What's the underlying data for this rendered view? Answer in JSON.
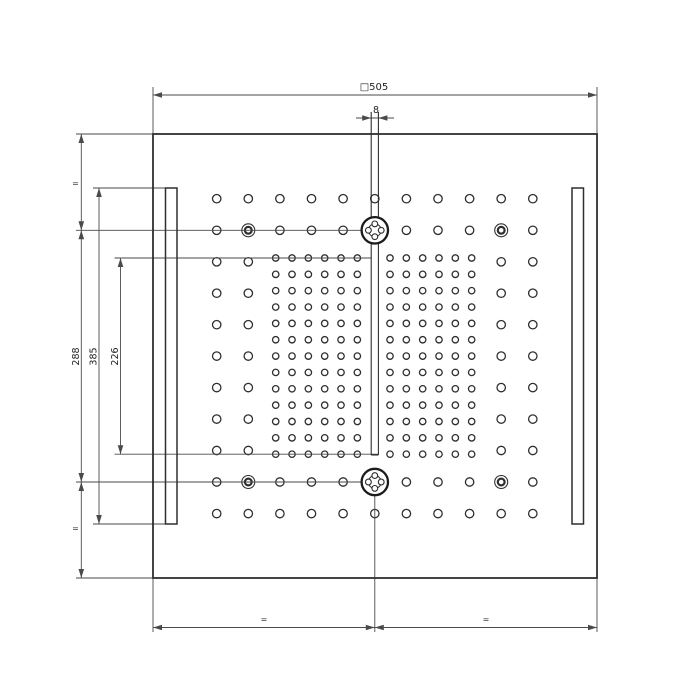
{
  "title": "Square ceiling shower head – dimensioned technical drawing",
  "canvas": {
    "w": 700,
    "h": 700,
    "bg": "#ffffff"
  },
  "style": {
    "dim_color": "#4a4a4a",
    "struct_color": "#2f2f2f",
    "hole_color": "#2e2e2e",
    "text_color": "#1f1f1f",
    "dim_w": 0.9,
    "panel_w": 1.8,
    "slot_w": 1.5,
    "channel_w": 1.1,
    "hole_w": 1.3,
    "arrow_len": 9,
    "arrow_halfw": 2.8
  },
  "dimensions": {
    "overall_square": "505",
    "channel_width": "8",
    "vertical_left": [
      "288",
      "385",
      "226"
    ],
    "equal_spacing_marks": [
      "=",
      "=",
      "=",
      "="
    ]
  },
  "panel": {
    "x": 153,
    "y": 134,
    "w": 444,
    "h": 444
  },
  "slots": [
    {
      "x": 165.5,
      "y": 188,
      "w": 11.5,
      "h": 336
    },
    {
      "x": 572.0,
      "y": 188,
      "w": 11.5,
      "h": 336
    }
  ],
  "channel": {
    "x1": 371.2,
    "x2": 378.4,
    "top": 112,
    "bottom": 455
  },
  "sparse_grid": {
    "hole_r": 4.2,
    "cols": [
      216.7,
      248.3,
      279.9,
      311.5,
      343.1,
      374.8,
      406.4,
      438.0,
      469.6,
      501.2,
      532.8
    ],
    "full_rows": [
      198.7,
      230.3,
      482.0,
      513.6
    ],
    "side_rows": [
      261.8,
      293.2,
      324.7,
      356.1,
      387.6,
      419.1,
      450.5
    ],
    "side_cols": [
      216.7,
      248.3,
      501.2,
      532.8
    ]
  },
  "dense_grid": {
    "hole_r": 3.2,
    "x0": 275.7,
    "y0": 258,
    "step_x": 16.33,
    "step_y": 16.35,
    "nx": 13,
    "ny": 13,
    "skip_col": 6
  },
  "features": {
    "nozzle_r": 13.2,
    "nozzle_ring_r": 6.4,
    "nozzle_petal_r": 2.9,
    "nozzles": [
      {
        "cx": 374.8,
        "cy": 230.3
      },
      {
        "cx": 374.8,
        "cy": 482.0
      }
    ],
    "ringed_outer_r": 6.5,
    "ringed_inner_r": 3.4,
    "ringed": [
      {
        "cx": 248.3,
        "cy": 230.3
      },
      {
        "cx": 501.2,
        "cy": 230.3
      },
      {
        "cx": 248.3,
        "cy": 482.0
      },
      {
        "cx": 501.2,
        "cy": 482.0
      }
    ]
  },
  "lines": [
    {
      "x1": 153,
      "y1": 95,
      "x2": 597,
      "y2": 95,
      "name": "dim-line-overall-505"
    },
    {
      "x1": 153,
      "y1": 87,
      "x2": 153,
      "y2": 134,
      "name": "ext-line-top-left"
    },
    {
      "x1": 597,
      "y1": 87,
      "x2": 597,
      "y2": 134,
      "name": "ext-line-top-right"
    },
    {
      "x1": 356,
      "y1": 118,
      "x2": 394,
      "y2": 118,
      "name": "dim-line-channel-8"
    },
    {
      "x1": 81.3,
      "y1": 134,
      "x2": 81.3,
      "y2": 578,
      "name": "dim-line-left-stack"
    },
    {
      "x1": 99,
      "y1": 188,
      "x2": 99,
      "y2": 524,
      "name": "dim-line-385"
    },
    {
      "x1": 120.5,
      "y1": 258,
      "x2": 120.5,
      "y2": 454.2,
      "name": "dim-line-226"
    },
    {
      "x1": 76,
      "y1": 134,
      "x2": 153,
      "y2": 134,
      "name": "ext-line-panel-top"
    },
    {
      "x1": 76,
      "y1": 230.3,
      "x2": 361.8,
      "y2": 230.3,
      "name": "ext-line-upper-jet-row"
    },
    {
      "x1": 93,
      "y1": 188,
      "x2": 165.5,
      "y2": 188,
      "name": "ext-line-slot-top"
    },
    {
      "x1": 114.5,
      "y1": 258,
      "x2": 371.2,
      "y2": 258,
      "name": "ext-line-dense-top"
    },
    {
      "x1": 114.5,
      "y1": 454.2,
      "x2": 378.4,
      "y2": 454.2,
      "name": "ext-line-dense-bottom"
    },
    {
      "x1": 76,
      "y1": 482,
      "x2": 361.8,
      "y2": 482,
      "name": "ext-line-lower-jet-row"
    },
    {
      "x1": 93,
      "y1": 524,
      "x2": 177,
      "y2": 524,
      "name": "ext-line-slot-bottom"
    },
    {
      "x1": 76,
      "y1": 578,
      "x2": 153,
      "y2": 578,
      "name": "ext-line-panel-bottom"
    },
    {
      "x1": 153,
      "y1": 627.5,
      "x2": 597,
      "y2": 627.5,
      "name": "dim-line-bottom-equal"
    },
    {
      "x1": 153,
      "y1": 578,
      "x2": 153,
      "y2": 632,
      "name": "ext-line-bottom-left"
    },
    {
      "x1": 597,
      "y1": 578,
      "x2": 597,
      "y2": 632,
      "name": "ext-line-bottom-right"
    },
    {
      "x1": 374.8,
      "y1": 495,
      "x2": 374.8,
      "y2": 632,
      "name": "ext-line-center"
    }
  ],
  "arrows": [
    {
      "x": 153,
      "y": 95,
      "dir": "left",
      "name": "arrow-505-left"
    },
    {
      "x": 597,
      "y": 95,
      "dir": "right",
      "name": "arrow-505-right"
    },
    {
      "x": 371.2,
      "y": 118,
      "dir": "right",
      "name": "arrow-8-left"
    },
    {
      "x": 378.4,
      "y": 118,
      "dir": "left",
      "name": "arrow-8-right"
    },
    {
      "x": 81.3,
      "y": 134,
      "dir": "up",
      "name": "arrow-eq-top"
    },
    {
      "x": 81.3,
      "y": 230.3,
      "dir": "down",
      "name": "arrow-288-top-meet"
    },
    {
      "x": 81.3,
      "y": 230.3,
      "dir": "up",
      "name": "arrow-288-top"
    },
    {
      "x": 81.3,
      "y": 482,
      "dir": "down",
      "name": "arrow-288-bottom"
    },
    {
      "x": 81.3,
      "y": 482,
      "dir": "up",
      "name": "arrow-eq-bottom-meet"
    },
    {
      "x": 81.3,
      "y": 578,
      "dir": "down",
      "name": "arrow-eq-bottom"
    },
    {
      "x": 99,
      "y": 188,
      "dir": "up",
      "name": "arrow-385-top"
    },
    {
      "x": 99,
      "y": 524,
      "dir": "down",
      "name": "arrow-385-bottom"
    },
    {
      "x": 120.5,
      "y": 258,
      "dir": "up",
      "name": "arrow-226-top"
    },
    {
      "x": 120.5,
      "y": 454.2,
      "dir": "down",
      "name": "arrow-226-bottom"
    },
    {
      "x": 153,
      "y": 627.5,
      "dir": "left",
      "name": "arrow-bottom-eq1-left"
    },
    {
      "x": 374.8,
      "y": 627.5,
      "dir": "right",
      "name": "arrow-bottom-eq1-right"
    },
    {
      "x": 374.8,
      "y": 627.5,
      "dir": "left",
      "name": "arrow-bottom-eq2-left"
    },
    {
      "x": 597,
      "y": 627.5,
      "dir": "right",
      "name": "arrow-bottom-eq2-right"
    }
  ],
  "labels": [
    {
      "text": "□505",
      "x": 374,
      "y": 90,
      "size": 10,
      "rot": 0,
      "name": "dim-label-overall-505"
    },
    {
      "text": "8",
      "x": 376,
      "y": 113,
      "size": 9.5,
      "rot": 0,
      "name": "dim-label-channel-8"
    },
    {
      "text": "=",
      "x": 75.5,
      "y": 186,
      "size": 8,
      "rot": 0,
      "name": "dim-label-equal-top"
    },
    {
      "text": "288",
      "x": 79,
      "y": 356.5,
      "size": 9.5,
      "rot": -90,
      "name": "dim-label-288"
    },
    {
      "text": "385",
      "x": 96.5,
      "y": 356.5,
      "size": 9.5,
      "rot": -90,
      "name": "dim-label-385"
    },
    {
      "text": "226",
      "x": 118,
      "y": 356.5,
      "size": 9.5,
      "rot": -90,
      "name": "dim-label-226"
    },
    {
      "text": "=",
      "x": 75.5,
      "y": 531,
      "size": 8,
      "rot": 0,
      "name": "dim-label-equal-bottom"
    },
    {
      "text": "=",
      "x": 264,
      "y": 622,
      "size": 8,
      "rot": 0,
      "name": "dim-label-equal-bl"
    },
    {
      "text": "=",
      "x": 486,
      "y": 622,
      "size": 8,
      "rot": 0,
      "name": "dim-label-equal-br"
    }
  ]
}
